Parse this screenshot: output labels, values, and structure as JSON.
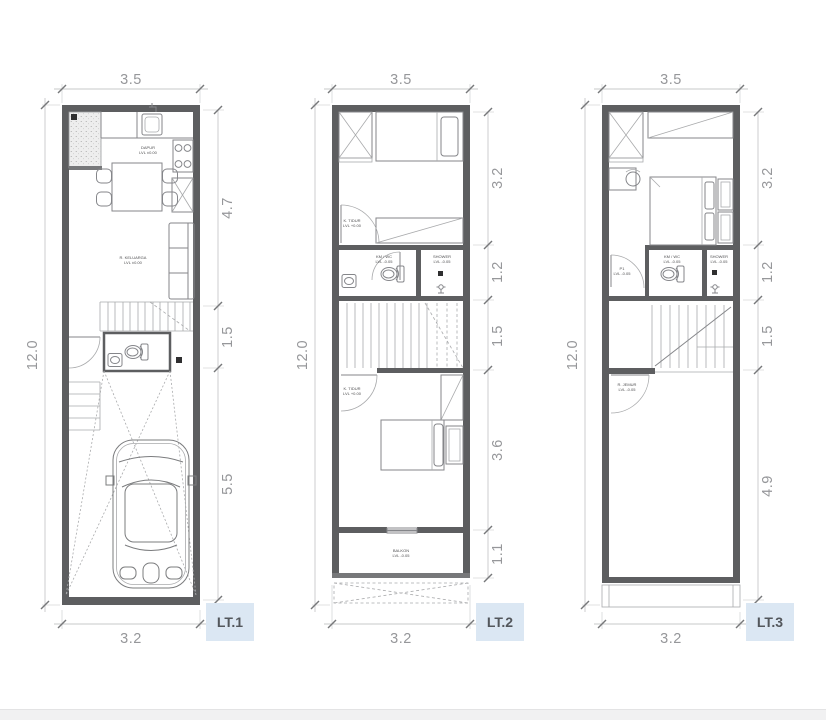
{
  "page": {
    "background": "#ffffff"
  },
  "colors": {
    "wall": "#5d5e60",
    "furniture_line": "#85868a",
    "dim_line": "#c7c8ca",
    "dim_text": "#96979a",
    "badge_bg": "#dbe7f3",
    "badge_text": "#53575c"
  },
  "plans": [
    {
      "badge": "LT.1",
      "dims": {
        "top": "3.5",
        "bottom": "3.2",
        "left": "12.0",
        "right": [
          "4.7",
          "1.5",
          "5.5"
        ]
      },
      "labels": {
        "kitchen": [
          "DAPUR",
          "LVL ±0.00"
        ],
        "living": [
          "R. KELUARGA",
          "LVL ±0.00"
        ]
      }
    },
    {
      "badge": "LT.2",
      "dims": {
        "top": "3.5",
        "bottom": "3.2",
        "left": "12.0",
        "right": [
          "3.2",
          "1.2",
          "1.5",
          "3.6",
          "1.1"
        ]
      },
      "labels": {
        "bedroom1": [
          "K. TIDUR",
          "LVL +0.00"
        ],
        "bath": [
          "KM / WC",
          "LVL -0.05"
        ],
        "shower": [
          "SHOWER",
          "LVL -0.05"
        ],
        "bedroom2": [
          "K. TIDUR",
          "LVL +0.00"
        ],
        "balcony": [
          "BALKON",
          "LVL -0.05"
        ]
      }
    },
    {
      "badge": "LT.3",
      "dims": {
        "top": "3.5",
        "bottom": "3.2",
        "left": "12.0",
        "right": [
          "3.2",
          "1.2",
          "1.5",
          "4.9"
        ]
      },
      "labels": {
        "door": [
          "P1",
          "LVL -0.05"
        ],
        "bath": [
          "KM / WC",
          "LVL -0.05"
        ],
        "shower": [
          "SHOWER",
          "LVL -0.05"
        ],
        "laundry": [
          "R. JEMUR",
          "LVL -0.05"
        ]
      }
    }
  ]
}
